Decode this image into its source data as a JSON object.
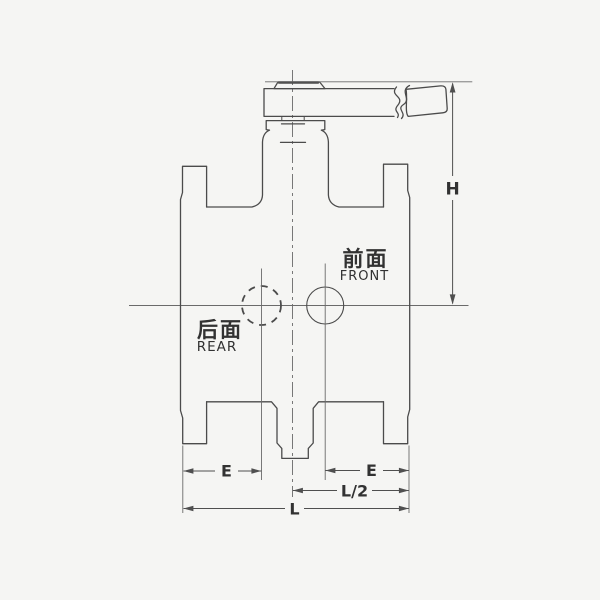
{
  "drawing": {
    "title": "valve-outline-drawing",
    "view": "front-elevation"
  },
  "annotations": {
    "front": {
      "cn": "前面",
      "en": "FRONT"
    },
    "rear": {
      "cn": "后面",
      "en": "REAR"
    }
  },
  "dimensions": {
    "height": "H",
    "end_to_center_left": "E",
    "end_to_center_right": "E",
    "half_length": "L/2",
    "length": "L"
  },
  "colors": {
    "background": "#f5f5f3",
    "line": "#4b4b4b",
    "thin": "#6b6b6b",
    "dim": "#4f4f4f",
    "text": "#303030"
  }
}
